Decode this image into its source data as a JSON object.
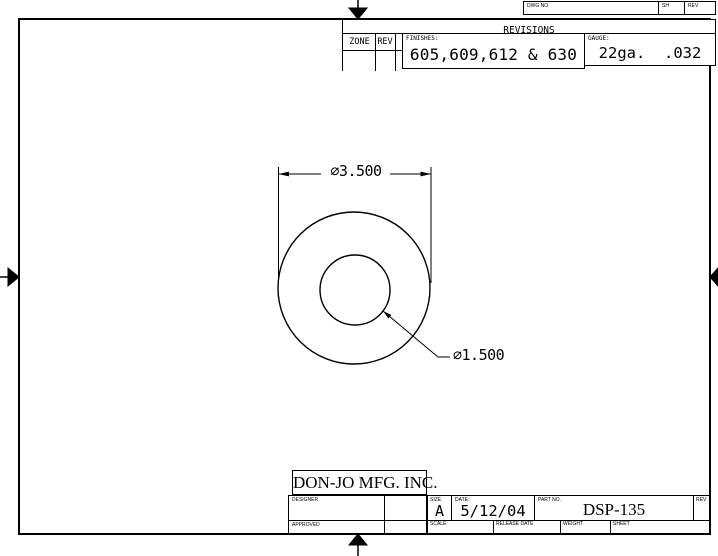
{
  "revisions_strip": {
    "dwg_no_label": "DWG NO",
    "sh_label": "SH",
    "rev_label": "REV"
  },
  "revisions": {
    "title": "REVISIONS",
    "zone_label": "ZONE",
    "rev_label": "REV",
    "finishes_label": "FINISHES:",
    "finishes_value": "605,609,612 & 630",
    "gauge_label": "GAUGE:",
    "gauge_value": "22ga.  .032"
  },
  "drawing": {
    "outer_diameter_dim": "∅3.500",
    "inner_diameter_dim": "∅1.500"
  },
  "title_block": {
    "company": "DON-JO MFG. INC.",
    "designer_label": "DESIGNER",
    "approved_label": "APPROVED",
    "size_label": "SIZE",
    "size_value": "A",
    "date_label": "DATE:",
    "date_value": "5/12/04",
    "part_no_label": "PART NO.",
    "part_no_value": "DSP-135",
    "rev_label": "REV",
    "scale_label": "SCALE",
    "release_date_label": "RELEASE DATE",
    "weight_label": "WEIGHT",
    "sheet_label": "SHEET"
  }
}
